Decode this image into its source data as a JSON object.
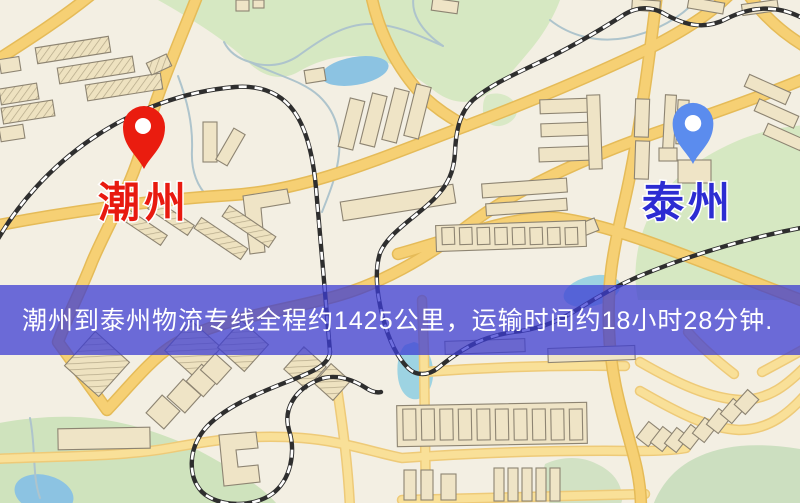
{
  "map": {
    "origin": {
      "name": "潮州",
      "pin_color": "#ea1c0f",
      "label_color": "#e81a10"
    },
    "destination": {
      "name": "泰州",
      "pin_color": "#5b8cee",
      "label_color": "#2c2cd2"
    },
    "banner": {
      "text": "潮州到泰州物流专线全程约1425公里，运输时间约18小时28分钟.",
      "distance_text": "1425公里",
      "duration_text": "18小时28分钟",
      "background_color": "#3c3cd2",
      "text_color": "#ffffff"
    },
    "colors": {
      "land": "#f3efe3",
      "road_major": "#f6d074",
      "road_minor": "#f9e098",
      "park": "#d6e8c2",
      "water": "#8cc3e2",
      "railway": "#2e2e2e",
      "building": "#efe4c6"
    }
  }
}
